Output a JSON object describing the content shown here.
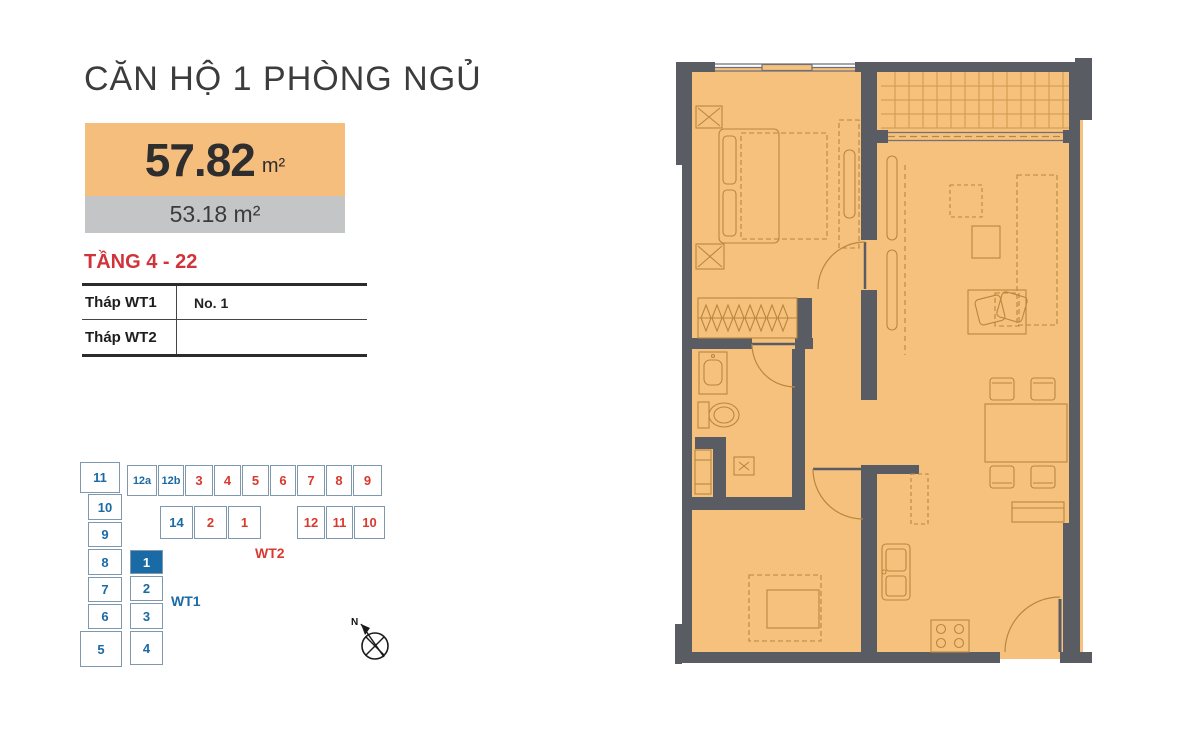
{
  "header": {
    "title": "CĂN HỘ 1 PHÒNG NGỦ"
  },
  "area": {
    "gross_value": "57.82",
    "gross_unit": "m²",
    "net_label": "53.18 m²",
    "gross_bg_color": "#f6be7d",
    "net_bg_color": "#c4c5c7"
  },
  "floors": {
    "label": "TẦNG 4 - 22",
    "color": "#d0343a"
  },
  "table": {
    "rows": [
      {
        "label": "Tháp WT1",
        "value": "No. 1"
      },
      {
        "label": "Tháp WT2",
        "value": ""
      }
    ]
  },
  "keyplan": {
    "left_col": [
      "11",
      "10",
      "9",
      "8",
      "7",
      "6",
      "5"
    ],
    "inner_col": [
      "1",
      "2",
      "3",
      "4"
    ],
    "top_row": [
      "12a",
      "12b",
      "3",
      "4",
      "5",
      "6",
      "7",
      "8",
      "9"
    ],
    "mid_row": [
      "14",
      "2",
      "1",
      "12",
      "11",
      "10"
    ],
    "wt1_label": "WT1",
    "wt2_label": "WT2",
    "north_label": "N",
    "highlighted_unit": "1",
    "colors": {
      "blue": "#1a6aa5",
      "red": "#da392f",
      "cell_border": "#7f98ad"
    }
  },
  "floorplan": {
    "colors": {
      "wall": "#595c62",
      "floor": "#f6c17c",
      "furniture_line": "#b8873e"
    },
    "rooms": [
      "bedroom",
      "wardrobe",
      "bathroom",
      "study",
      "kitchen",
      "living-dining",
      "balcony",
      "entrance"
    ]
  }
}
